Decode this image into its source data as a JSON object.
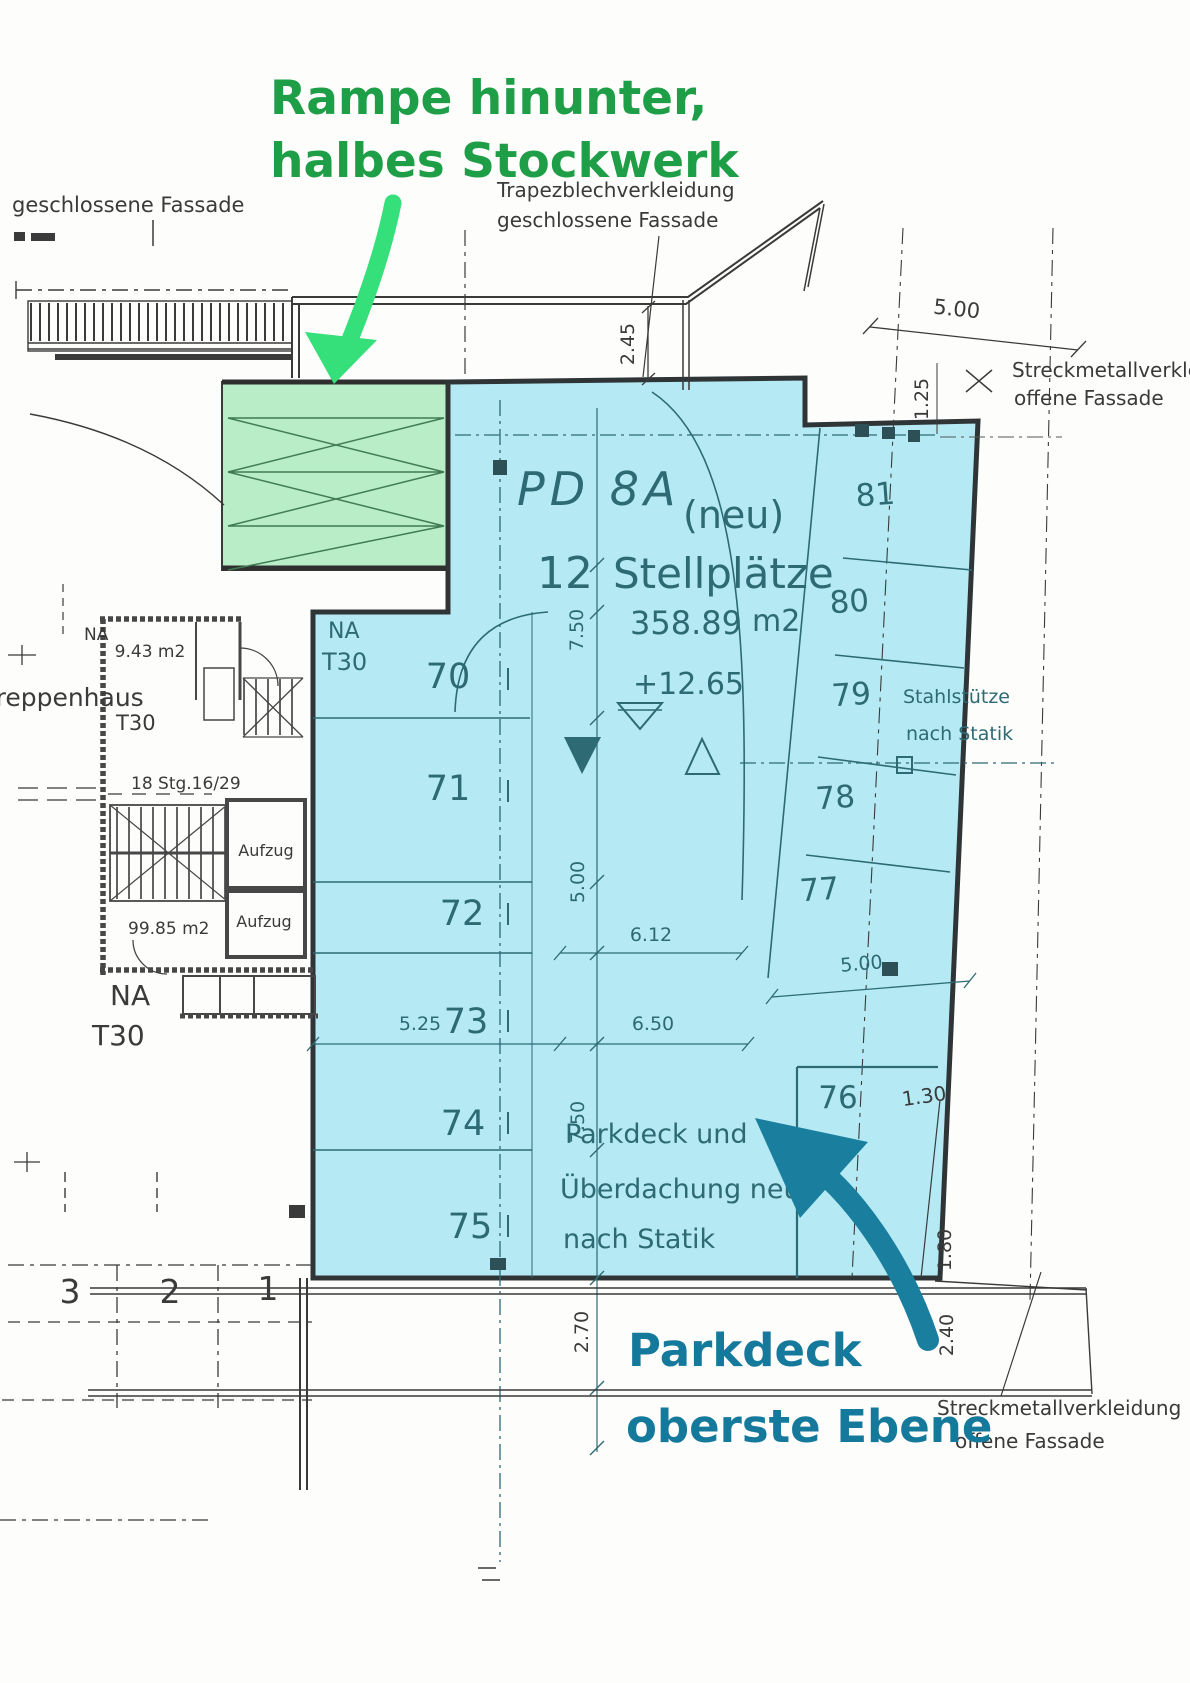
{
  "colors": {
    "cyan_fill": "#b5eaf4",
    "green_fill": "#b9edc7",
    "annotation_green": "#1d9e47",
    "arrow_green": "#35df79",
    "annotation_teal": "#15799c",
    "arrow_teal": "#1a7f9f",
    "ink": "#3a3a3a",
    "plan_teal": "#2d6a73"
  },
  "annotations": {
    "ramp_line1": "Rampe hinunter,",
    "ramp_line2": "halbes Stockwerk",
    "deck_line1": "Parkdeck",
    "deck_line2": "oberste Ebene"
  },
  "facade": {
    "top_left": "geschlossene Fassade",
    "trapez_line1": "Trapezblechverkleidung",
    "trapez_line2": "geschlossene Fassade",
    "streck_top_line1": "Streckmetallverkleidung",
    "streck_top_line2": "offene Fassade",
    "streck_bottom_line1": "Streckmetallverkleidung",
    "streck_bottom_line2": "offene Fassade"
  },
  "plan": {
    "code": "PD 8A",
    "variant": "(neu)",
    "count": "12",
    "count_label": "Stellplätze",
    "area_value": "358.89",
    "area_unit": "m2",
    "level": "+12.65"
  },
  "deck_note": {
    "line1": "Parkdeck und",
    "line2": "Überdachung neu",
    "line3": "nach Statik"
  },
  "steel_note": {
    "line1": "Stahlstütze",
    "line2": "nach Statik"
  },
  "stairwell": {
    "name": "Treppenhaus",
    "area_small": "9.43 m2",
    "stairs": "18 Stg.16/29",
    "lift": "Aufzug",
    "area_large": "99.85 m2",
    "na": "NA",
    "t30": "T30"
  },
  "spots": {
    "left": [
      "70",
      "71",
      "72",
      "73",
      "74",
      "75"
    ],
    "right": [
      "81",
      "80",
      "79",
      "78",
      "77"
    ],
    "lower": "76",
    "ground": [
      "3",
      "2",
      "1"
    ]
  },
  "dims": {
    "d245": "2.45",
    "d500_top": "5.00",
    "d125": "1.25",
    "d750_a": "7.50",
    "d500_mid": "5.00",
    "d612": "6.12",
    "d525": "5.25",
    "d650": "6.50",
    "d500_right": "5.00",
    "d750_b": "7.50",
    "d270": "2.70",
    "d240": "2.40",
    "d180": "1.80",
    "d130": "1.30"
  }
}
